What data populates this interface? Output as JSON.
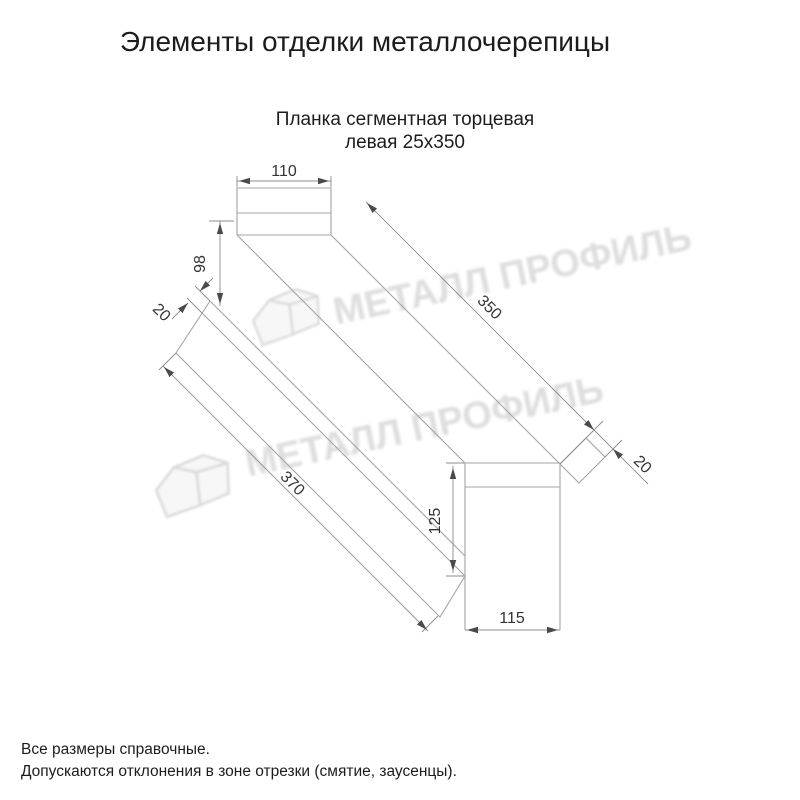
{
  "title": "Элементы отделки металлочерепицы",
  "subtitle": {
    "line1": "Планка сегментная торцевая",
    "line2": "левая 25х350"
  },
  "watermark": {
    "text": "МЕТАЛЛ ПРОФИЛЬ",
    "color": "#dedede"
  },
  "drawing": {
    "type": "isometric technical drawing of left segmental end strip 25x350",
    "line_color": "#a3a3a3",
    "dim_line_color": "#8c8c8c",
    "arrow_color": "#4a4a4a",
    "dims": {
      "top_width": "110",
      "left_height": "98",
      "left_fold": "20",
      "top_length": "350",
      "bottom_length": "370",
      "right_height": "125",
      "right_fold": "20",
      "bottom_width": "115"
    }
  },
  "notes": [
    "Все размеры справочные.",
    "Допускаются отклонения в зоне отрезки (смятие, заусенцы)."
  ]
}
